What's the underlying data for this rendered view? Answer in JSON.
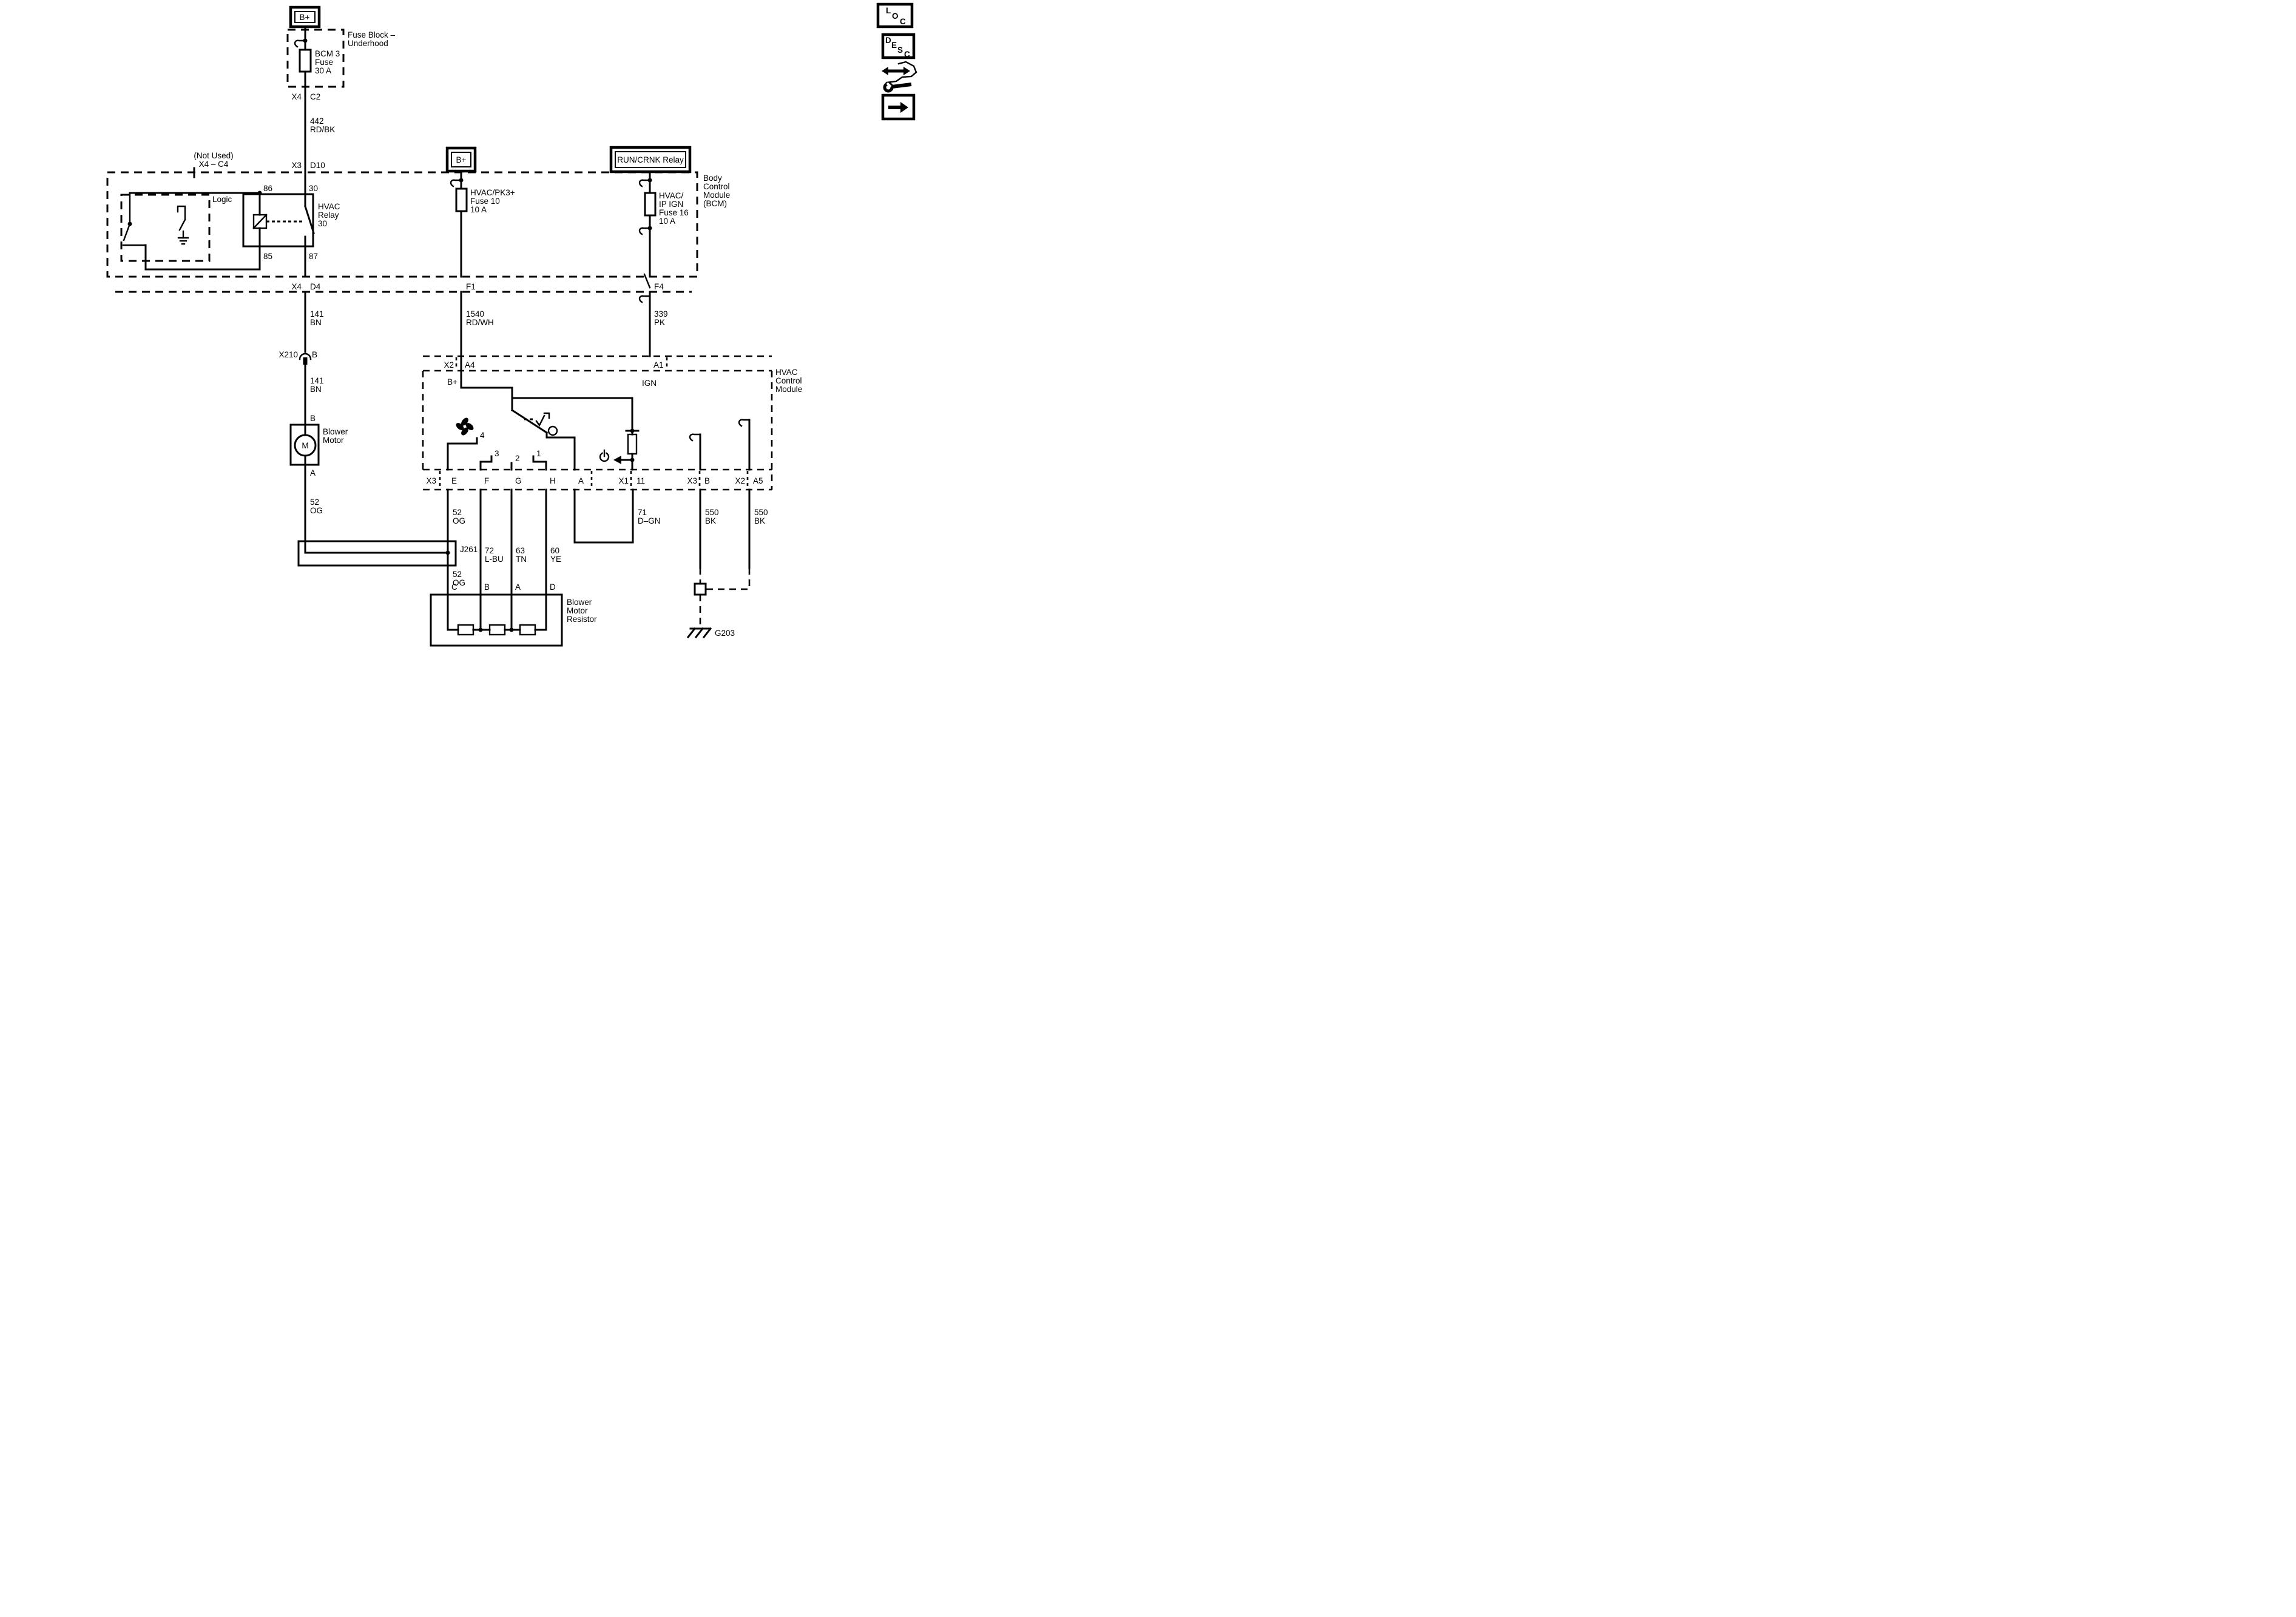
{
  "accent_color": "#000000",
  "background_color": "#ffffff",
  "sidebar": {
    "loc": [
      "L",
      "O",
      "C"
    ],
    "desc": [
      "D",
      "E",
      "S",
      "C"
    ],
    "icons": {
      "nav": "wrench-arrows-icon",
      "next": "arrow-right-icon"
    }
  },
  "feed_bcm3": {
    "source": "B+",
    "block": [
      "Fuse Block –",
      "Underhood"
    ],
    "fuse": [
      "BCM 3",
      "Fuse",
      "30 A"
    ],
    "conn_out": {
      "conn": "X4",
      "pin": "C2"
    },
    "wire": [
      "442",
      "RD/BK"
    ],
    "not_used": [
      "(Not Used)",
      "X4 – C4"
    ],
    "conn_in": {
      "conn": "X3",
      "pin": "D10"
    }
  },
  "bcm": {
    "name": [
      "Body",
      "Control",
      "Module",
      "(BCM)"
    ],
    "logic": "Logic",
    "relay": {
      "name": [
        "HVAC",
        "Relay",
        "30"
      ],
      "t86": "86",
      "t30": "30",
      "t85": "85",
      "t87": "87"
    },
    "out_blower": {
      "conn": "X4",
      "pin": "D4"
    },
    "out_f1": "F1",
    "out_f4": "F4"
  },
  "feed_pk3": {
    "source": "B+",
    "fuse": [
      "HVAC/PK3+",
      "Fuse 10",
      "10 A"
    ],
    "wire": [
      "1540",
      "RD/WH"
    ]
  },
  "feed_ign": {
    "source": "RUN/CRNK Relay",
    "fuse": [
      "HVAC/",
      "IP IGN",
      "Fuse 16",
      "10 A"
    ],
    "wire": [
      "339",
      "PK"
    ]
  },
  "blower_branch": {
    "wire_upper": [
      "141",
      "BN"
    ],
    "conn_mid": {
      "conn": "X210",
      "pin": "B"
    },
    "wire_lower": [
      "141",
      "BN"
    ],
    "pin_in": "B",
    "motor": [
      "Blower",
      "Motor"
    ],
    "motor_symbol": "M",
    "pin_out": "A",
    "wire_out": [
      "52",
      "OG"
    ],
    "splice": "J261",
    "wire_splice_out": [
      "52",
      "OG"
    ]
  },
  "hvac_module": {
    "name": [
      "HVAC",
      "Control",
      "Module"
    ],
    "in_bplus": {
      "conn": "X2",
      "pin": "A4",
      "net": "B+"
    },
    "in_ign": {
      "pin": "A1",
      "net": "IGN"
    },
    "switch_positions": {
      "p4": "4",
      "p3": "3",
      "p2": "2",
      "p1": "1"
    },
    "bottom": {
      "x3": "X3",
      "e": "E",
      "f": "F",
      "g": "G",
      "h": "H",
      "a": "A",
      "x1": "X1",
      "p11": "11",
      "x3b": "X3",
      "b": "B",
      "x2": "X2",
      "a5": "A5"
    }
  },
  "wires_lower": {
    "w52": [
      "52",
      "OG"
    ],
    "w72": [
      "72",
      "L-BU"
    ],
    "w63": [
      "63",
      "TN"
    ],
    "w60": [
      "60",
      "YE"
    ],
    "w71": [
      "71",
      "D–GN"
    ],
    "w550_b": [
      "550",
      "BK"
    ],
    "w550_a5": [
      "550",
      "BK"
    ]
  },
  "resistor": {
    "name": [
      "Blower",
      "Motor",
      "Resistor"
    ],
    "pins": {
      "c": "C",
      "b": "B",
      "a": "A",
      "d": "D"
    }
  },
  "ground": "G203"
}
